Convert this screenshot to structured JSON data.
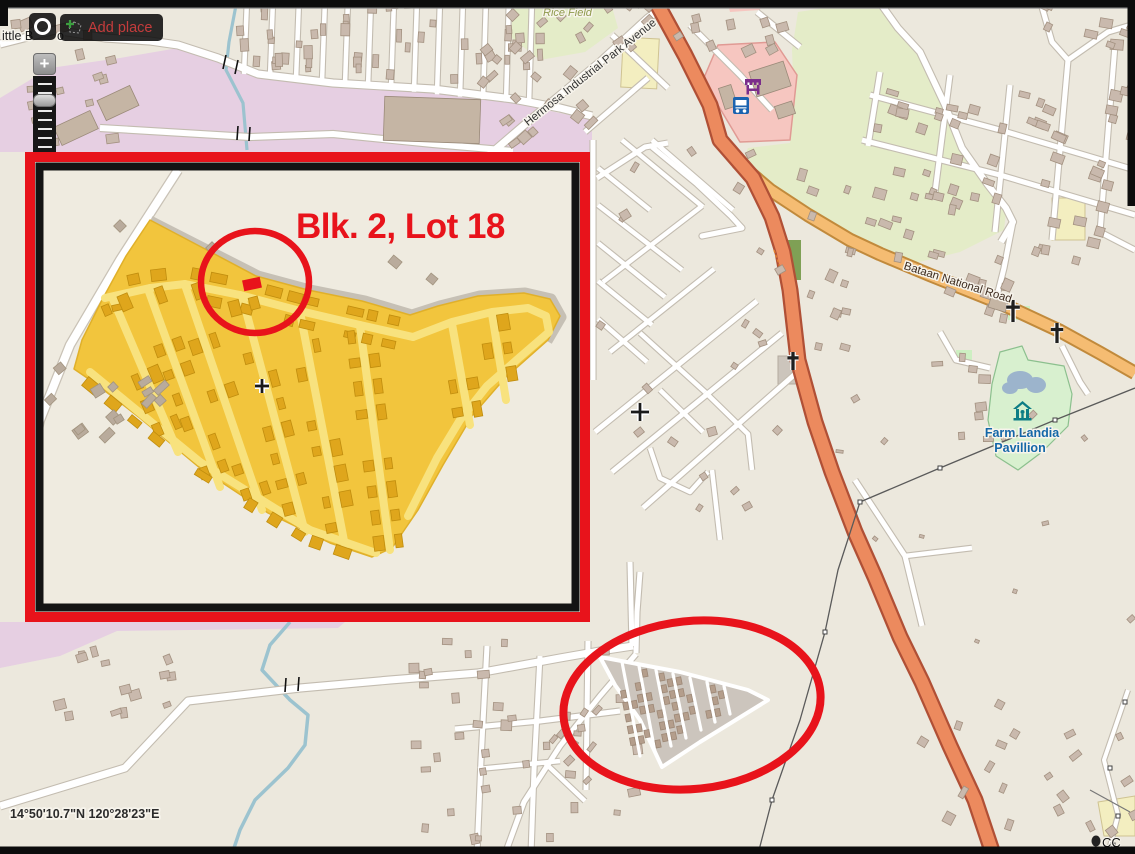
{
  "toolbar": {
    "add_place_label": "Add place"
  },
  "zoom_control": {
    "zoom_in_label": "+"
  },
  "map_labels": {
    "place_fragment_left": "ittle B",
    "place_fragment_right": "o",
    "rice_field": "Rice Field",
    "hermosa_avenue": "Hermosa Industrial Park Avenue",
    "bataan_road": "Bataan National Road",
    "farm_landia_line1": "Farm Landia",
    "farm_landia_line2": "Pavillion"
  },
  "annotations": {
    "inset_callout": "Blk. 2, Lot 18"
  },
  "status_bar": {
    "coordinates": "14°50'10.7\"N 120°28'23\"E",
    "attribution": "CC"
  },
  "colors": {
    "annotation_red": "#e8131b",
    "highlight_yellow": "#f2c53d",
    "highlight_road_yellow": "#f8e27e",
    "highlight_building_gold": "#dfa61c",
    "trunk_road_orange": "#ec8a5e",
    "secondary_road_orange": "#f5bc72",
    "industrial_purple": "#e6cfe2",
    "retail_pink": "#f6c6c0",
    "farmland_green": "#e4ecc8",
    "park_green": "#d8f0cf",
    "school_yellow": "#f3eec0",
    "water_blue": "#9cc3cf",
    "building_brown": "#c9b9ad",
    "map_background": "#ece8dd"
  }
}
